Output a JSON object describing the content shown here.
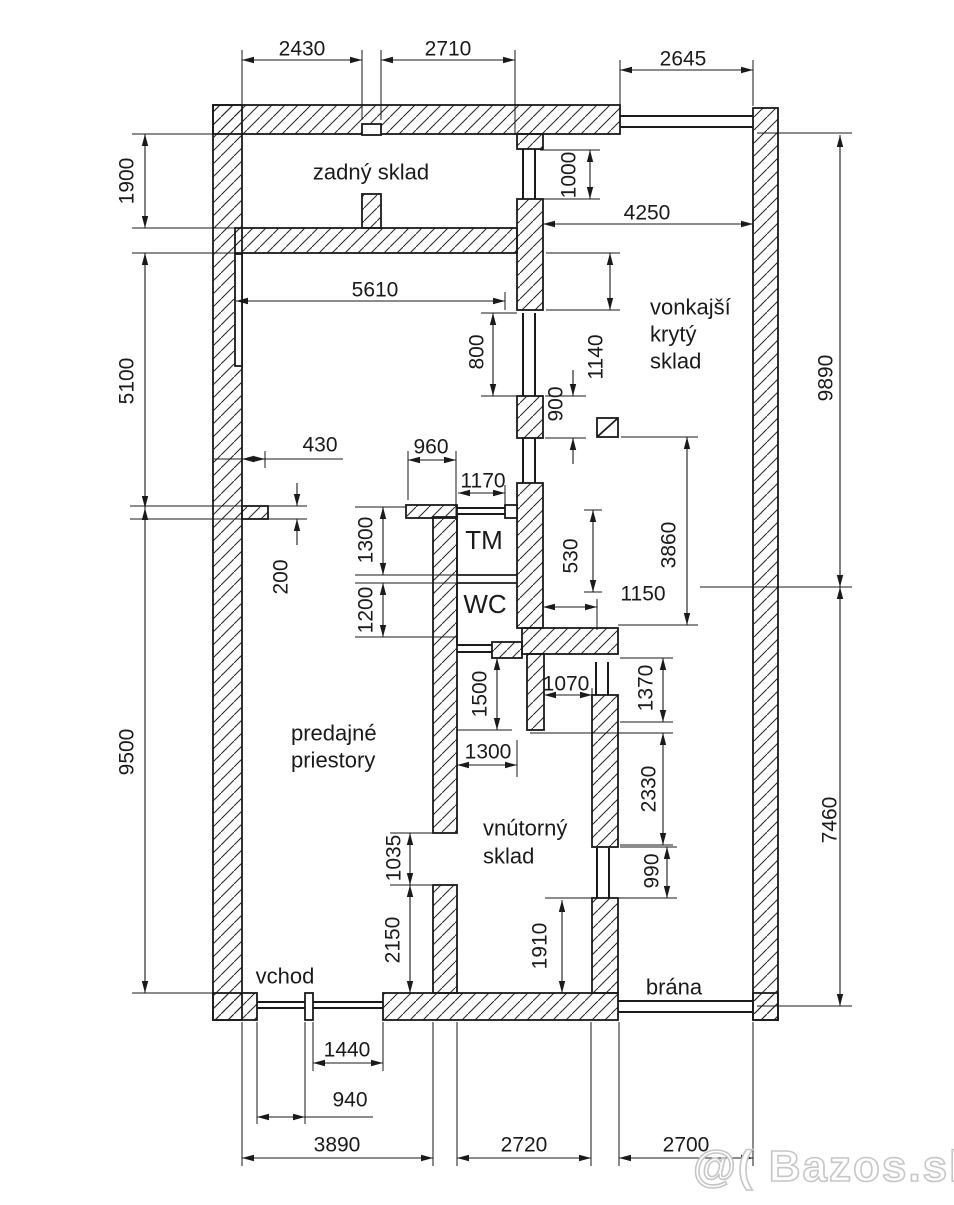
{
  "watermark": "@( Bazos.sk",
  "colors": {
    "line": "#1a1a1a",
    "watermark_outline": "#c6c6c6",
    "background": "#ffffff"
  },
  "rooms": {
    "back_storage": "zadný sklad",
    "outdoor_line1": "vonkajší",
    "outdoor_line2": "krytý",
    "outdoor_line3": "sklad",
    "sales_line1": "predajné",
    "sales_line2": "priestory",
    "inner_line1": "vnútorný",
    "inner_line2": "sklad",
    "tm": "TM",
    "wc": "WC",
    "entrance": "vchod",
    "gate": "brána"
  },
  "dims": {
    "d2430": "2430",
    "d2710": "2710",
    "d2645": "2645",
    "d1900": "1900",
    "d1000": "1000",
    "d4250": "4250",
    "d5610": "5610",
    "d800": "800",
    "d1140": "1140",
    "d900": "900",
    "d9890": "9890",
    "d5100": "5100",
    "d430": "430",
    "d960": "960",
    "d1170": "1170",
    "d200": "200",
    "d1300_tm": "1300",
    "d1200": "1200",
    "d530": "530",
    "d3860": "3860",
    "d1150": "1150",
    "d1070": "1070",
    "d1370": "1370",
    "d1500": "1500",
    "d1300_w": "1300",
    "d2330": "2330",
    "d990": "990",
    "d9500": "9500",
    "d1035": "1035",
    "d2150": "2150",
    "d1910": "1910",
    "d7460": "7460",
    "d1440": "1440",
    "d940": "940",
    "d3890": "3890",
    "d2720": "2720",
    "d2700": "2700"
  }
}
